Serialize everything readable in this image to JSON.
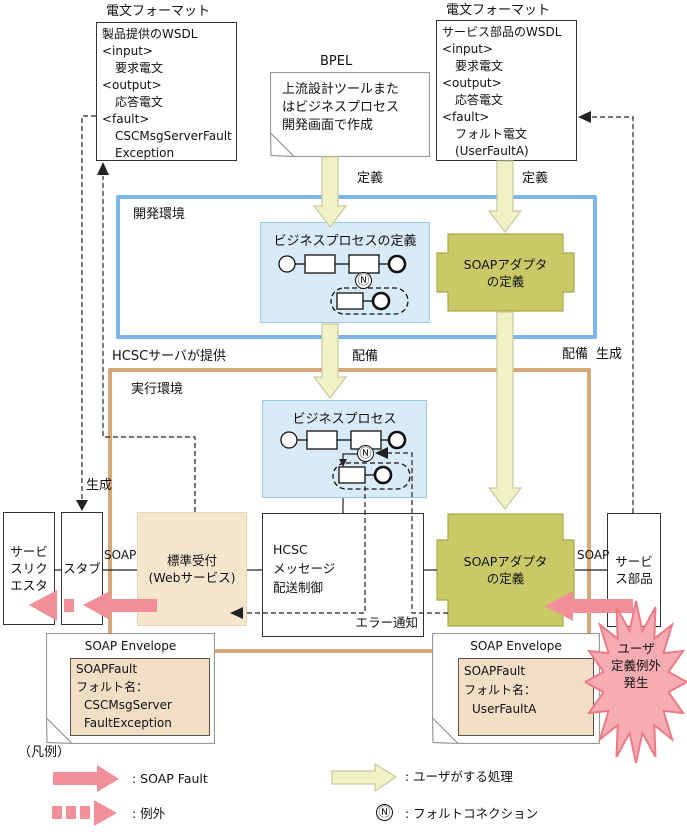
{
  "colors": {
    "dev_env_border": "#7CB5E8",
    "runtime_env_border": "#D7A877",
    "business_process_fill": "#D9EAF8",
    "adapter_fill": "#C9C967",
    "reception_fill": "#F6E5CD",
    "envelope_inner_fill": "#F1DEC5",
    "soap_fault_pink": "#F2909A",
    "burst_fill": "#F7ACB4",
    "user_arrow_yellow": "#F1F1C6"
  },
  "icons": {
    "fault_connection": "Ⓝ"
  },
  "msg_format_left": {
    "title": "電文フォーマット",
    "lines": [
      "製品提供のWSDL",
      "<input>",
      "要求電文",
      "<output>",
      "応答電文",
      "<fault>",
      "CSCMsgServerFault",
      "Exception"
    ]
  },
  "msg_format_right": {
    "title": "電文フォーマット",
    "lines": [
      "サービス部品のWSDL",
      "<input>",
      "要求電文",
      "<output>",
      "応答電文",
      "<fault>",
      "フォルト電文",
      "(UserFaultA)"
    ]
  },
  "bpel_note": {
    "title": "BPEL",
    "text": "上流設計ツールまた\nはビジネスプロセス\n開発画面で作成"
  },
  "flow_labels": {
    "define_left": "定義",
    "define_right": "定義",
    "deploy_left": "配備",
    "deploy_right": "配備",
    "generate_left": "生成",
    "generate_right": "生成",
    "hcsc_provides": "HCSCサーバが提供"
  },
  "dev_env": {
    "label": "開発環境",
    "bp_def_title": "ビジネスプロセスの定義",
    "adapter": "SOAPアダプタ\nの定義"
  },
  "runtime_env": {
    "label": "実行環境",
    "bp_title": "ビジネスプロセス",
    "adapter": "SOAPアダプタ\nの定義",
    "reception": "標準受付\n(Webサービス)",
    "hcsc": "HCSC\nメッセージ\n配送制御",
    "error_notice": "エラー通知",
    "requester": "サービ\nスリク\nエスタ",
    "stub": "スタブ",
    "service_part": "サービ\nス部品",
    "soap_left": "SOAP",
    "soap_right": "SOAP"
  },
  "envelope_left": {
    "title": "SOAP Envelope",
    "lines": [
      "SOAPFault",
      "フォルト名：",
      "CSCMsgServer",
      "FaultException"
    ]
  },
  "envelope_right": {
    "title": "SOAP Envelope",
    "lines": [
      "SOAPFault",
      "フォルト名：",
      "UserFaultA"
    ]
  },
  "burst": {
    "text": "ユーザ\n定義例外\n発生"
  },
  "legend": {
    "title": "（凡例）",
    "soap_fault": ": SOAP Fault",
    "exception": ": 例外",
    "user_process": ": ユーザがする処理",
    "fault_connection": ": フォルトコネクション"
  }
}
